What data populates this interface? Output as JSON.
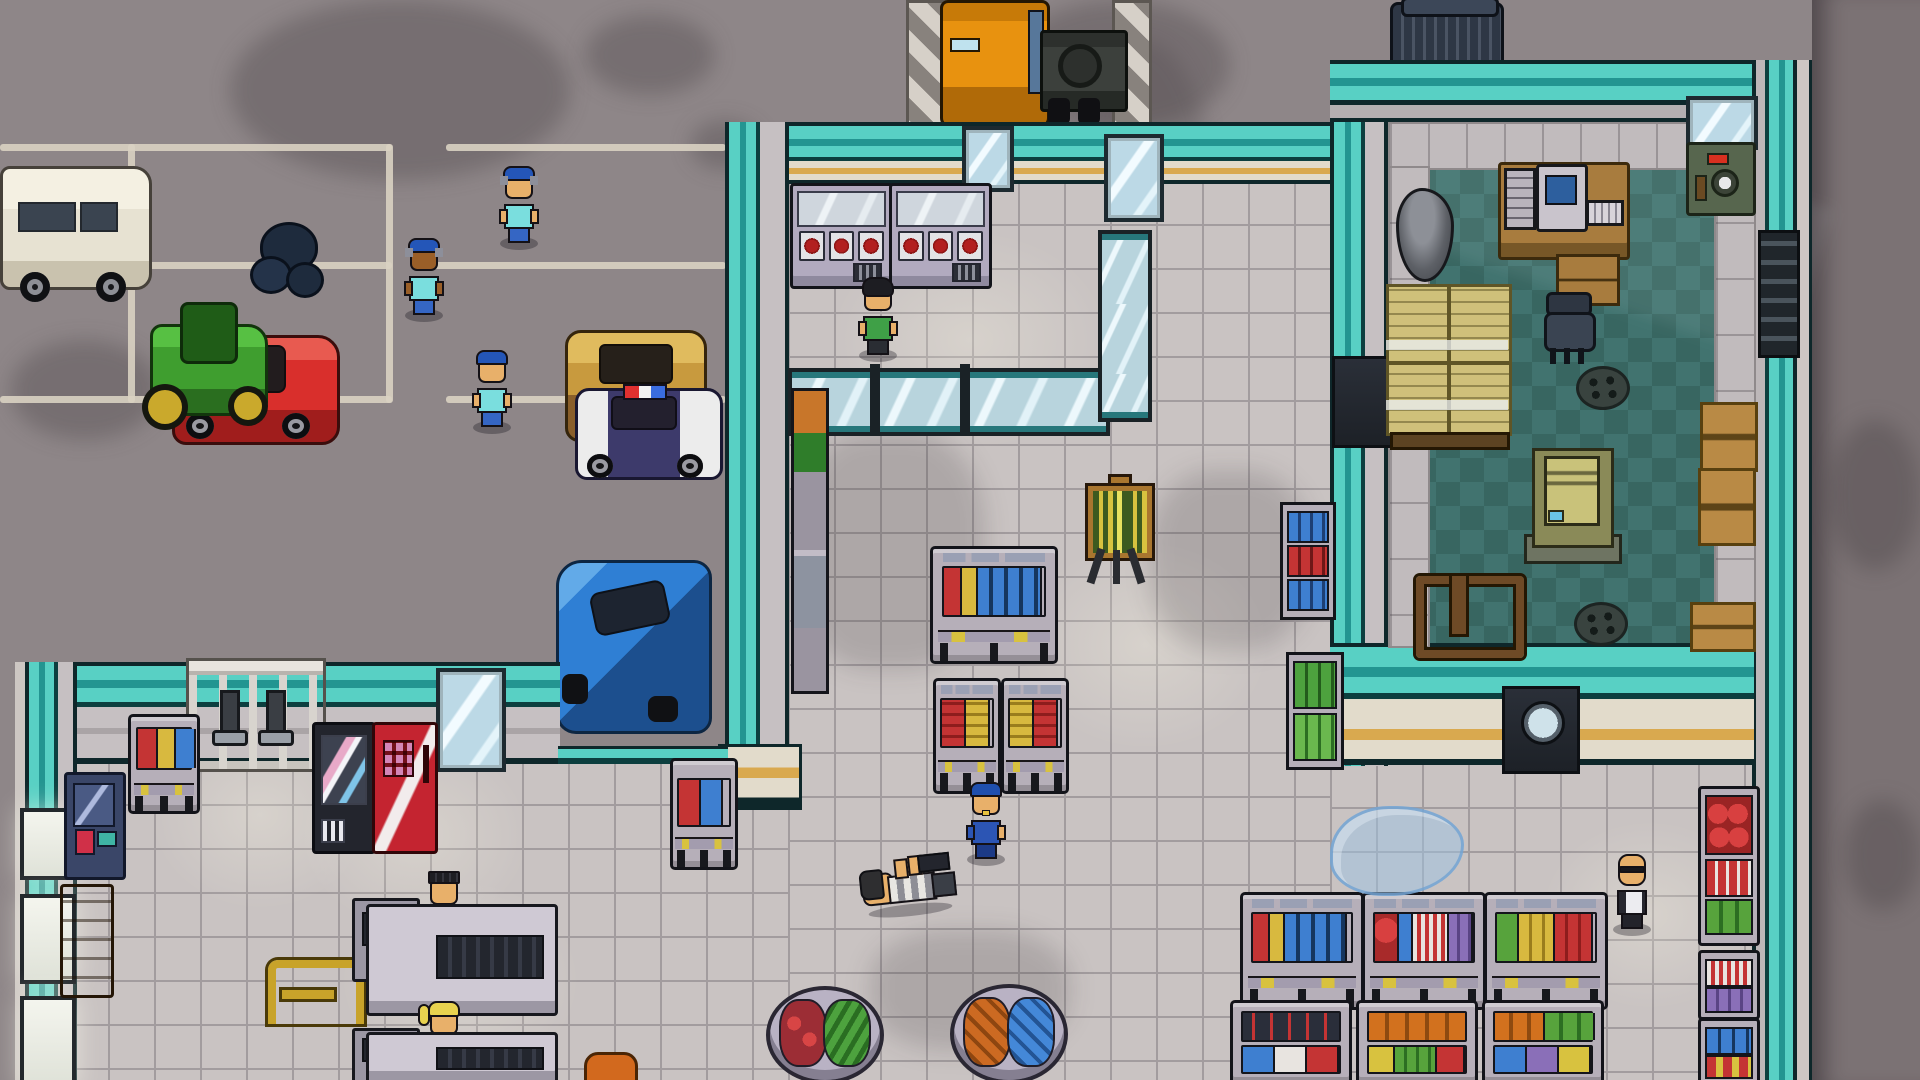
{
  "scene_label": "Top-down pixel-art supermarket with parking lot, loading dock and stock room",
  "palette": {
    "asphalt": "#8e8688",
    "concrete": "#7b7274",
    "parking_line": "#d9d2c2",
    "tile": "#c9c3c2",
    "tile_line": "#a29c9e",
    "teal_bright": "#58d0c4",
    "teal_mid": "#239591",
    "wall_face": "#c6c0c2",
    "face_cream": "#e2dbcb",
    "stripe_tan": "#d9a94f",
    "br_floor_a": "#41736f",
    "br_floor_b": "#386661",
    "glass": "#bcd9e6",
    "skin": "#e8b06a",
    "skin_dark": "#9a5f28",
    "cap_blue": "#2456b8",
    "worker_shirt": "#7adede",
    "jeans": "#3566c4",
    "officer_blue": "#2c55b4",
    "apron_green": "#3fa047",
    "hair_black": "#1d1d22",
    "hair_blonde": "#e8d24f",
    "suit_dark": "#26262e",
    "truck_orange": "#e8920f",
    "trailer_gray": "#3c403c",
    "van_cream": "#e7e2d2",
    "car_red": "#d92f2c",
    "car_blue": "#2f7fd4",
    "car_tan": "#c89a3e",
    "tractor_green": "#3f9e2f",
    "police_navy": "#3d3a6b",
    "vending_red": "#c42430",
    "vending_dark": "#23252d",
    "crate_yellow": "#cfc07a",
    "box_brown": "#b98a45",
    "safe_green": "#57664e",
    "easel_board": "#3d5a1f",
    "easel_frame": "#a9762f",
    "puddle_blue": "#9ec4e4"
  },
  "entities": {
    "vehicles": {
      "van": "White van",
      "sports_car": "Red sports car",
      "tractor": "Green tractor",
      "sedan": "Tan sedan",
      "police_car": "Police car",
      "hatchback": "Blue hatchback",
      "semi_truck": "Semi truck at loading dock"
    },
    "npcs": {
      "worker": "Store worker",
      "officer": "Police officer",
      "clerk": "Clerk",
      "cashier": "Cashier",
      "downed_inmate": "Knocked-out inmate",
      "agent": "Bald man in suit",
      "shopper": "Shopper"
    },
    "fixtures": {
      "freezer": "Meat freezer case",
      "shelf": "Goods shelf",
      "vending_dark": "Snack vending machine",
      "vending_red": "Soda vending machine",
      "arcade": "Arcade cabinet",
      "bench": "Wooden bench",
      "turnstile": "Entrance turnstile",
      "easel": "Sign easel",
      "produce_bin": "Produce bin",
      "checkout": "Checkout counter",
      "register": "Cash register",
      "basket_stand": "Basket stand",
      "safe": "Safe",
      "desk": "Office desk",
      "computer": "Computer",
      "chair": "Office chair",
      "crates": "Crate pallet",
      "generator": "Generator unit",
      "dumpster": "Dumpster",
      "drain": "Floor drain",
      "puddle": "Water puddle",
      "boxes": "Cardboard boxes",
      "fridge": "Drinks fridge",
      "mirror": "Glass panel",
      "window": "Window",
      "door": "Door",
      "ladder": "Wall ladder",
      "trash": "Trash bags",
      "frame": "Pallet frame",
      "loading_dock": "Loading dock"
    }
  }
}
